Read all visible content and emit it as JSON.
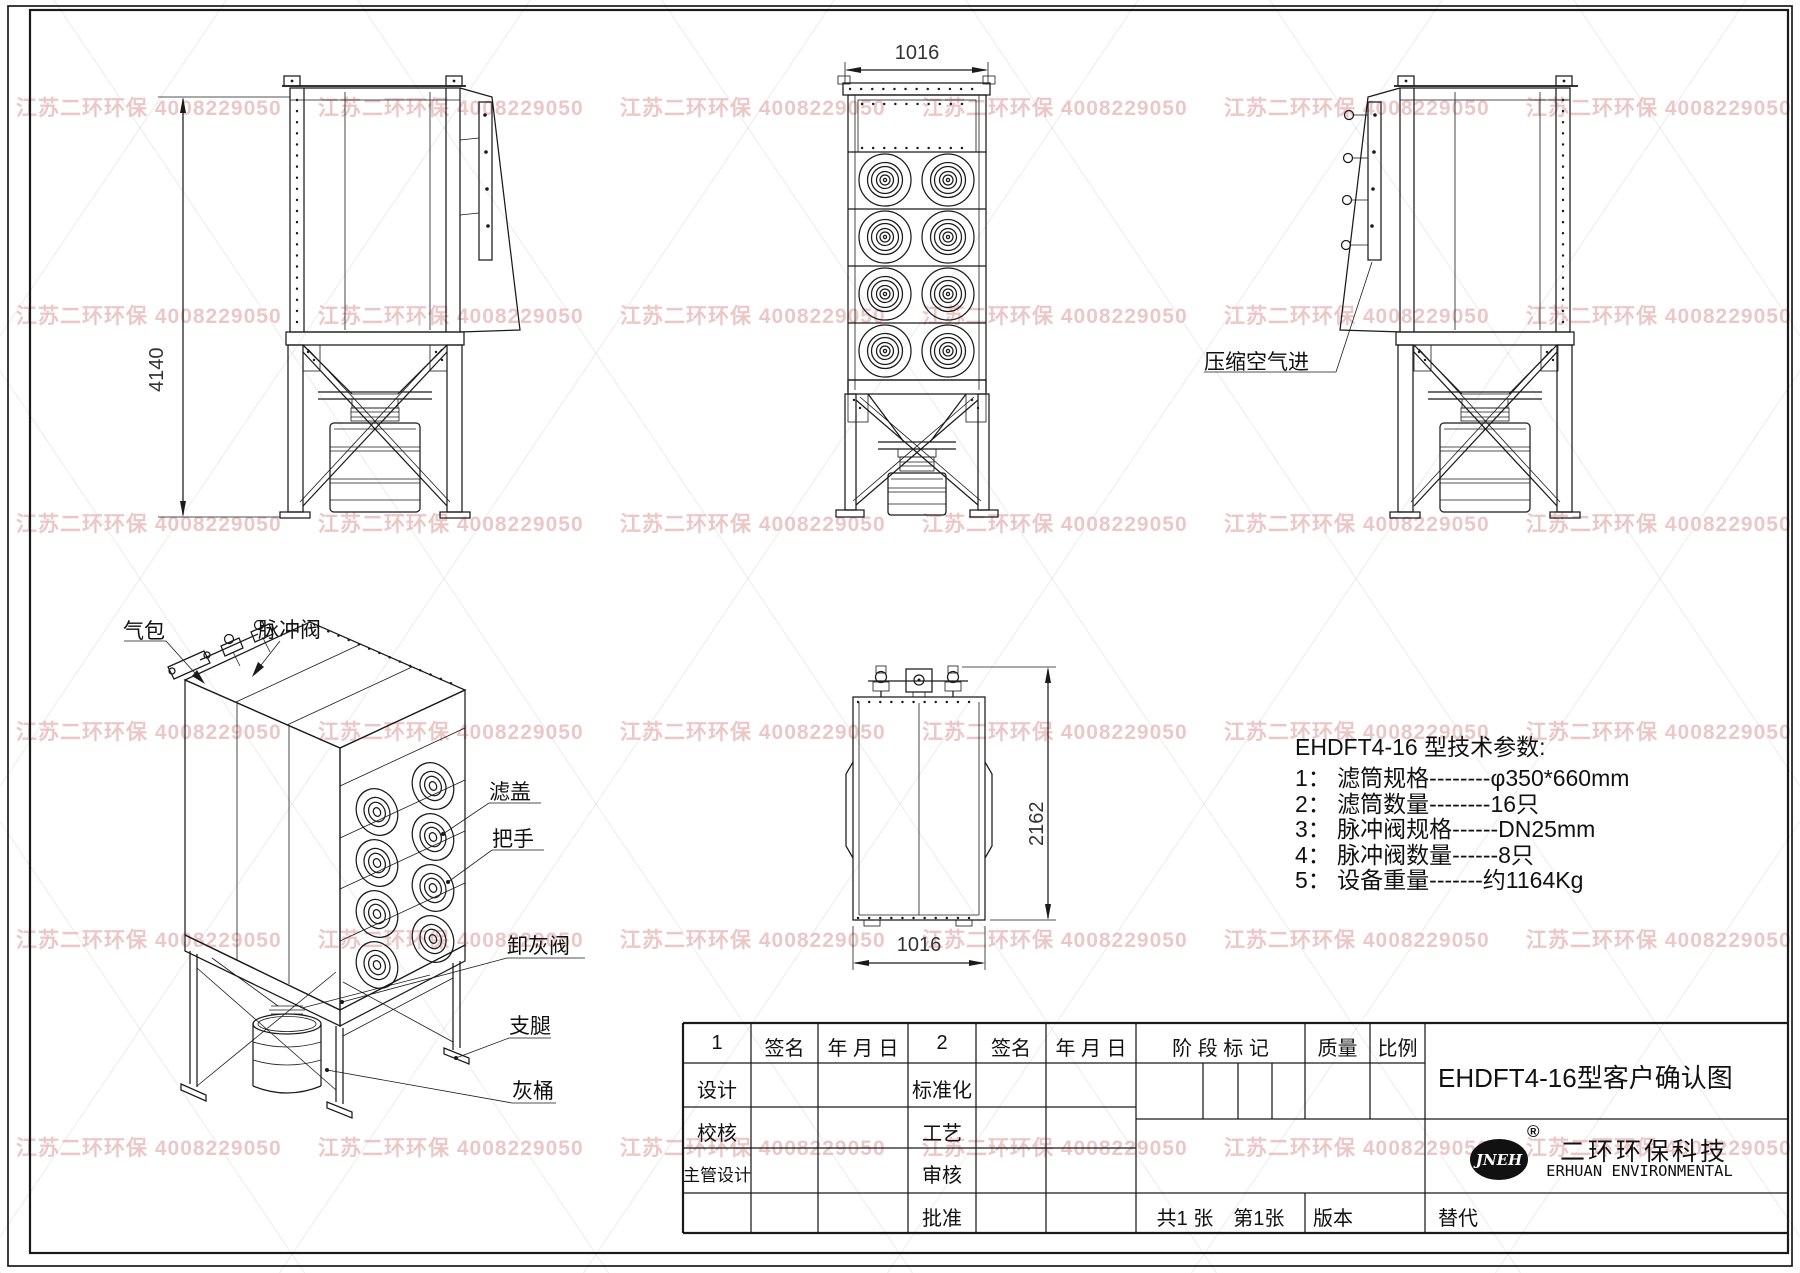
{
  "watermark": {
    "text": "江苏二环环保 4008229050"
  },
  "drawing": {
    "dims": {
      "side_height": "4140",
      "front_width": "1016",
      "top_depth": "2162",
      "top_width": "1016"
    },
    "callouts": {
      "air_inlet": "压缩空气进",
      "air_bag": "气包",
      "pulse_valve": "脉冲阀",
      "filter_cover": "滤盖",
      "handle": "把手",
      "ash_valve": "卸灰阀",
      "support_leg": "支腿",
      "ash_bucket": "灰桶"
    }
  },
  "tech_params": {
    "title": "EHDFT4-16 型技术参数:",
    "items": [
      "1： 滤筒规格--------φ350*660mm",
      "2： 滤筒数量--------16只",
      "3： 脉冲阀规格------DN25mm",
      "4： 脉冲阀数量------8只",
      "5： 设备重量-------约1164Kg"
    ]
  },
  "title_block": {
    "h_col1": "1",
    "h_sign1": "签名",
    "h_date1": "年 月 日",
    "h_col2": "2",
    "h_sign2": "签名",
    "h_date2": "年 月 日",
    "h_stage": "阶 段 标 记",
    "h_quality": "质量",
    "h_scale": "比例",
    "r1_left": "设计",
    "r1_mid": "标准化",
    "r2_left": "校核",
    "r2_mid": "工艺",
    "r3_left": "主管设计",
    "r3_mid": "审核",
    "r4_mid": "批准",
    "sheet_info": "共1 张　第1张",
    "version": "版本",
    "replace": "替代",
    "drawing_title": "EHDFT4-16型客户确认图",
    "company_cn": "二环环保科技",
    "company_en": "ERHUAN ENVIRONMENTAL",
    "logo_text": "JNEH",
    "registered": "®"
  }
}
